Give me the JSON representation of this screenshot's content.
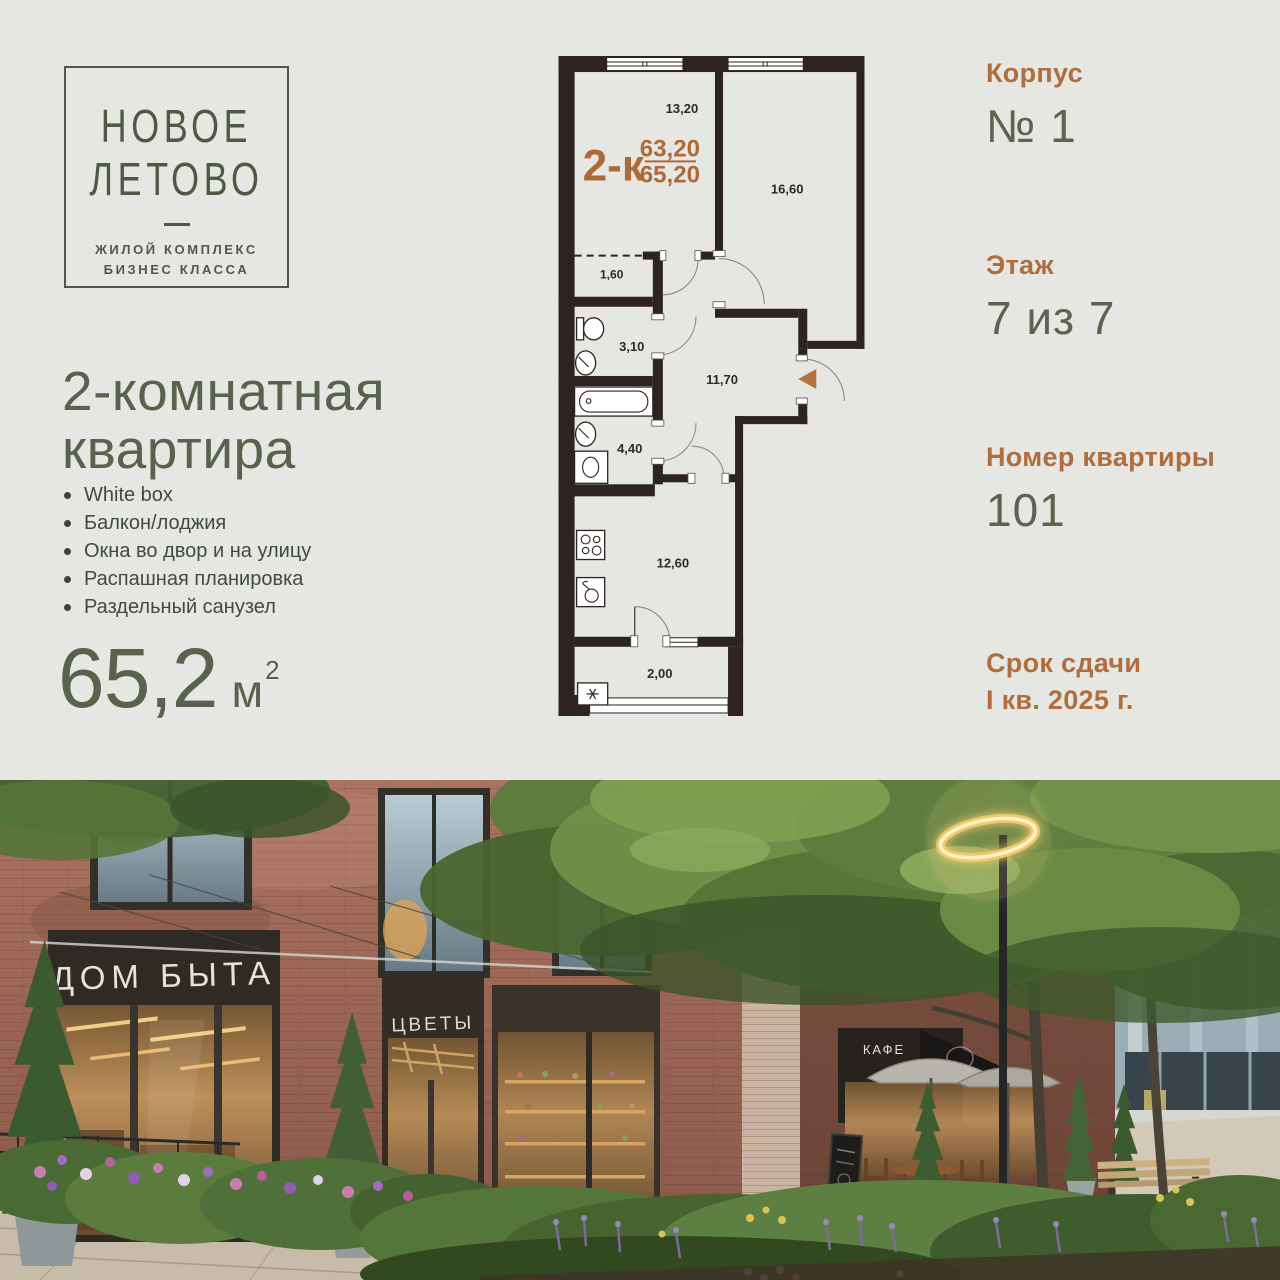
{
  "logo": {
    "line1": "НОВОЕ",
    "line2": "ЛЕТОВО",
    "subtitle_line1": "ЖИЛОЙ КОМПЛЕКС",
    "subtitle_line2": "БИЗНЕС КЛАССА",
    "color": "#4e5a43"
  },
  "listing": {
    "title_line1": "2-комнатная",
    "title_line2": "квартира",
    "features": [
      "White box",
      "Балкон/лоджия",
      "Окна во двор и на улицу",
      "Распашная планировка",
      "Раздельный санузел"
    ],
    "area_value": "65,2",
    "area_unit": "м",
    "area_sup": "2"
  },
  "details": {
    "korpus_label": "Корпус",
    "korpus_value": "№ 1",
    "floor_label": "Этаж",
    "floor_value": "7 из 7",
    "apartment_label": "Номер квартиры",
    "apartment_value": "101",
    "deadline_label": "Срок сдачи",
    "deadline_value": "I кв. 2025 г.",
    "label_color": "#b06e3f",
    "value_color": "#5b6450"
  },
  "plan": {
    "type_label": "2-к",
    "area_upper": "63,20",
    "area_lower": "65,20",
    "accent_color": "#ad6a38",
    "wall_color": "#2d2320",
    "rooms": {
      "living": "13,20",
      "bedroom": "16,60",
      "wardrobe": "1,60",
      "wc": "3,10",
      "bathroom": "4,40",
      "hall": "11,70",
      "kitchen": "12,60",
      "balcony": "2,00"
    }
  },
  "photo": {
    "signs": {
      "left_store": "ДОМ БЫТА",
      "flower_store": "ЦВЕТЫ",
      "cafe": "КАФЕ"
    }
  }
}
